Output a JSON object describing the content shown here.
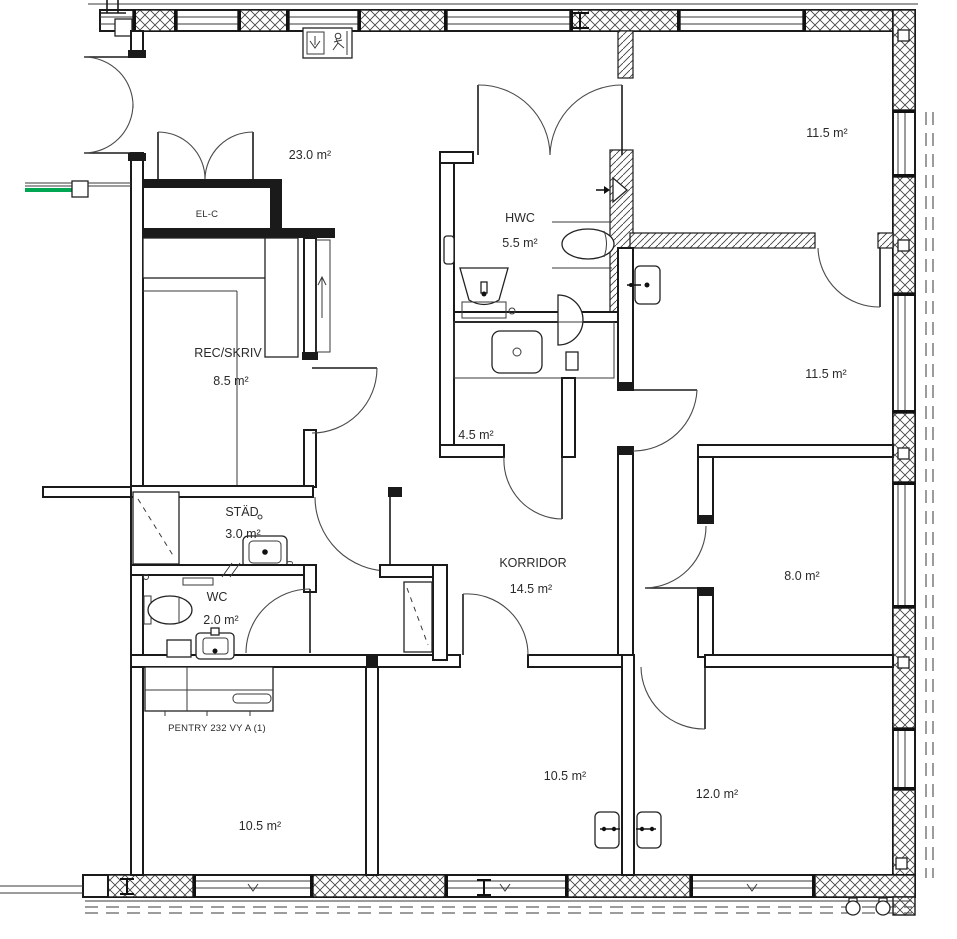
{
  "title": "Floor plan",
  "labels": {
    "room23_area": "23.0 m²",
    "elc_name": "EL-C",
    "rec_name": "REC/SKRIV",
    "rec_area": "8.5 m²",
    "hwc_name": "HWC",
    "hwc_area": "5.5 m²",
    "r115_top_area": "11.5 m²",
    "r115_mid_area": "11.5 m²",
    "r45_area": "4.5 m²",
    "stad_name": "STÄD",
    "stad_area": "3.0 m²",
    "wc_name": "WC",
    "wc_area": "2.0 m²",
    "korridor_name": "KORRIDOR",
    "korridor_area": "14.5 m²",
    "r80_area": "8.0 m²",
    "pentry_name": "PENTRY 232 VY A (1)",
    "r105_left_area": "10.5 m²",
    "r105_mid_area": "10.5 m²",
    "r120_area": "12.0 m²",
    "dim_50": "50"
  },
  "colors": {
    "line": "#1a1a1a",
    "text": "#2a2a2a",
    "green": "#00a651",
    "bg": "#ffffff"
  }
}
